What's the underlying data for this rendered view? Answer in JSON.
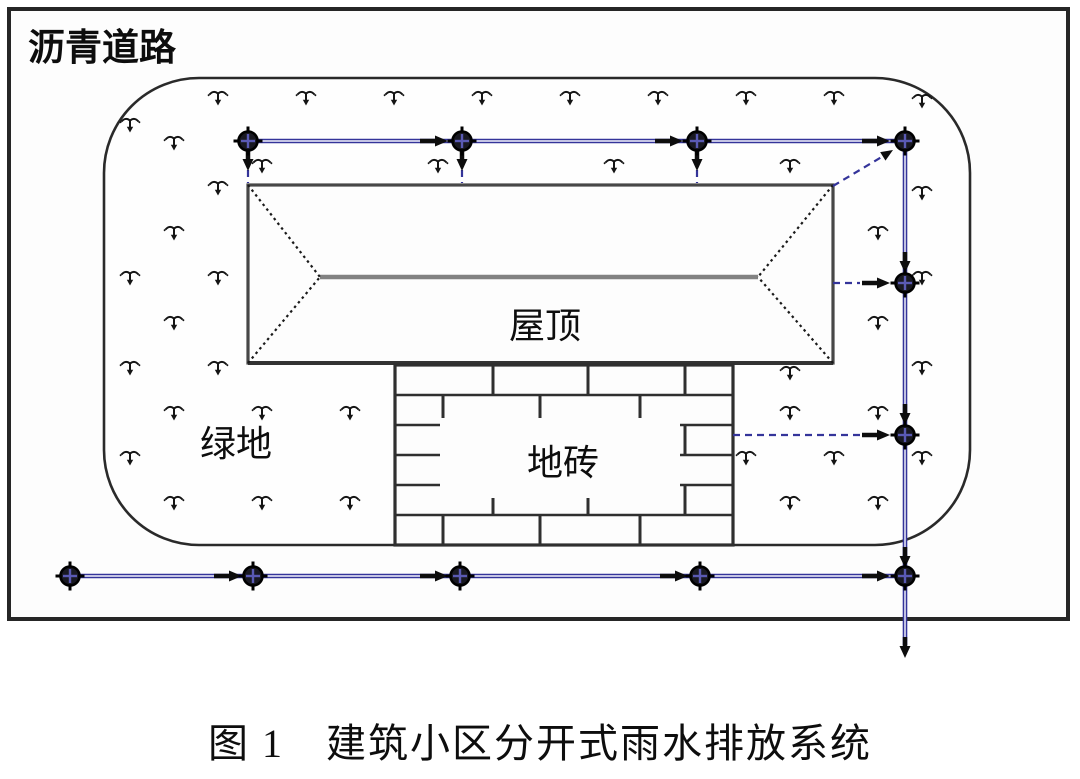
{
  "figure": {
    "caption": "图 1　建筑小区分开式雨水排放系统"
  },
  "labels": {
    "road": "沥青道路",
    "roof": "屋顶",
    "green_space": "绿地",
    "tiles": "地砖"
  },
  "colors": {
    "pipe": "#34349a",
    "pipe_core": "#d9d9ee",
    "manhole_cross": "#5a5ab4",
    "frame": "#262626",
    "boundary": "#2a2a2a",
    "roof_line": "#474747",
    "ridge": "#828282",
    "brick_line": "#2f2f2f",
    "ink": "#0d0d0d"
  },
  "diagram": {
    "frame": {
      "x": 9,
      "y": 9,
      "w": 1059,
      "h": 610
    },
    "green_boundary": {
      "x": 104,
      "y": 78,
      "w": 866,
      "h": 467,
      "r": 95
    },
    "roof": {
      "x": 248,
      "y": 185,
      "w": 585,
      "h": 178,
      "ridge_y": 277,
      "apex_left_x": 320,
      "apex_right_x": 758
    },
    "bricks": {
      "x": 395,
      "y": 365,
      "w": 338,
      "h": 180,
      "rows": 6,
      "joints_even": [
        493,
        588,
        685
      ],
      "joints_odd": [
        443,
        540,
        640
      ],
      "label_bg": {
        "x": 440,
        "y": 418,
        "w": 240,
        "h": 80
      }
    },
    "pipes": [
      {
        "x1": 248,
        "y1": 141,
        "x2": 905,
        "y2": 141
      },
      {
        "x1": 905,
        "y1": 141,
        "x2": 905,
        "y2": 645
      },
      {
        "x1": 70,
        "y1": 576,
        "x2": 905,
        "y2": 576
      }
    ],
    "dashed_lines": [
      [
        248,
        170,
        248,
        183
      ],
      [
        462,
        170,
        462,
        183
      ],
      [
        697,
        170,
        697,
        183
      ],
      [
        833,
        186,
        890,
        152
      ],
      [
        833,
        283,
        860,
        283
      ],
      [
        733,
        435,
        860,
        435
      ]
    ],
    "diag_arrow": {
      "x": 893,
      "y": 150,
      "angle": -32
    },
    "manholes": [
      [
        248,
        141
      ],
      [
        462,
        141
      ],
      [
        697,
        141
      ],
      [
        905,
        141
      ],
      [
        905,
        283
      ],
      [
        905,
        435
      ],
      [
        70,
        576
      ],
      [
        253,
        576
      ],
      [
        460,
        576
      ],
      [
        700,
        576
      ],
      [
        905,
        576
      ]
    ],
    "arrows_right": [
      [
        420,
        141
      ],
      [
        655,
        141
      ],
      [
        862,
        141
      ],
      [
        862,
        283
      ],
      [
        862,
        435
      ],
      [
        214,
        576
      ],
      [
        420,
        576
      ],
      [
        660,
        576
      ],
      [
        862,
        576
      ]
    ],
    "arrows_down": [
      [
        248,
        150
      ],
      [
        462,
        150
      ],
      [
        697,
        150
      ],
      [
        905,
        252
      ],
      [
        905,
        404
      ],
      [
        905,
        547
      ],
      [
        905,
        637
      ]
    ],
    "grass": [
      [
        218,
        97
      ],
      [
        306,
        97
      ],
      [
        394,
        97
      ],
      [
        482,
        97
      ],
      [
        570,
        97
      ],
      [
        658,
        97
      ],
      [
        746,
        97
      ],
      [
        834,
        97
      ],
      [
        922,
        100
      ],
      [
        174,
        142
      ],
      [
        130,
        124
      ],
      [
        262,
        165
      ],
      [
        438,
        165
      ],
      [
        614,
        165
      ],
      [
        790,
        165
      ],
      [
        218,
        187
      ],
      [
        922,
        192
      ],
      [
        174,
        232
      ],
      [
        878,
        232
      ],
      [
        130,
        277
      ],
      [
        218,
        277
      ],
      [
        922,
        277
      ],
      [
        174,
        322
      ],
      [
        878,
        322
      ],
      [
        130,
        367
      ],
      [
        218,
        367
      ],
      [
        790,
        372
      ],
      [
        922,
        367
      ],
      [
        174,
        412
      ],
      [
        262,
        412
      ],
      [
        350,
        412
      ],
      [
        790,
        412
      ],
      [
        878,
        412
      ],
      [
        130,
        457
      ],
      [
        746,
        457
      ],
      [
        834,
        457
      ],
      [
        922,
        457
      ],
      [
        174,
        502
      ],
      [
        262,
        502
      ],
      [
        350,
        502
      ],
      [
        790,
        502
      ],
      [
        878,
        502
      ]
    ],
    "text_pos": {
      "road": [
        28,
        60
      ],
      "roof": [
        545,
        338
      ],
      "green_space": [
        236,
        456
      ],
      "tiles": [
        563,
        475
      ],
      "caption": [
        540,
        757
      ]
    }
  }
}
